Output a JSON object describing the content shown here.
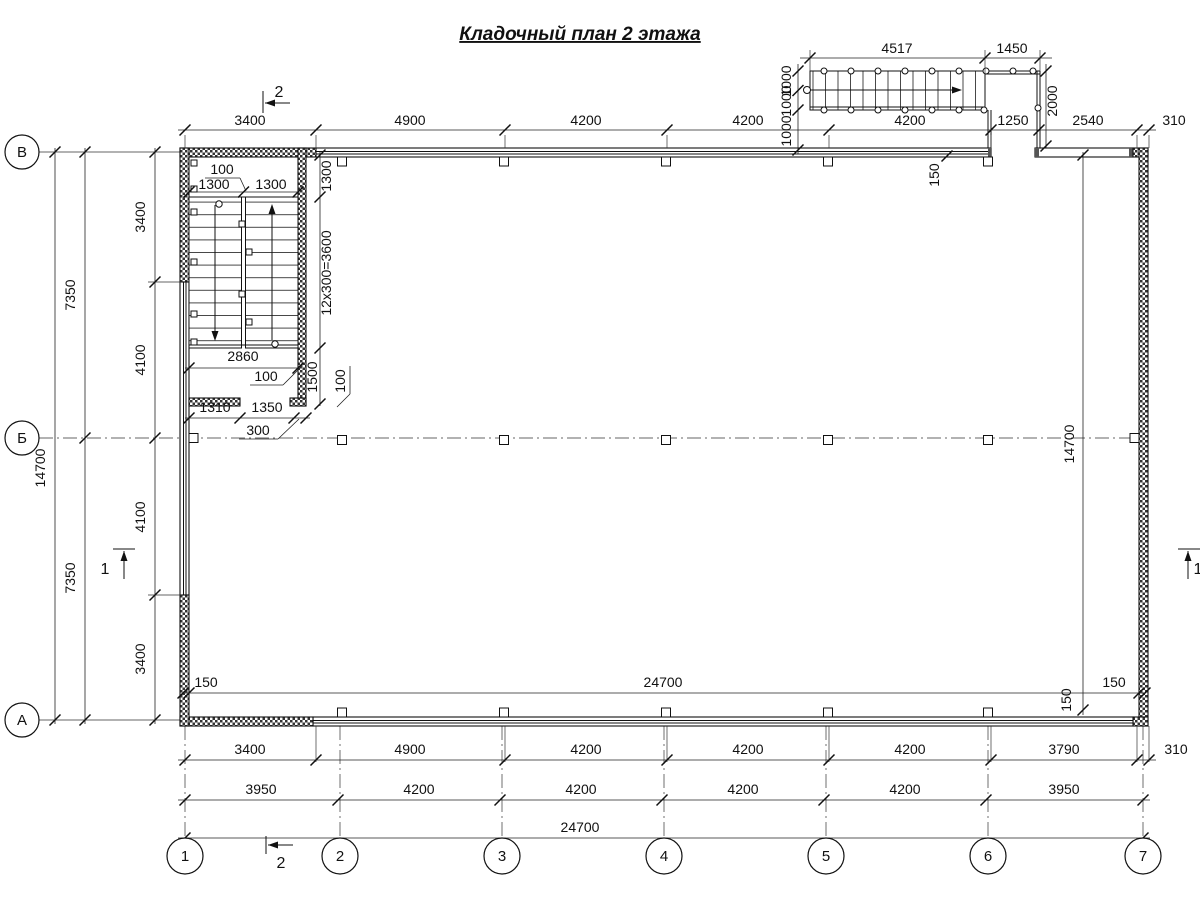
{
  "title": "Кладочный план 2 этажа",
  "axes": {
    "rows": [
      "В",
      "Б",
      "А"
    ],
    "cols": [
      "1",
      "2",
      "3",
      "4",
      "5",
      "6",
      "7"
    ]
  },
  "sections": {
    "cut1": "1",
    "cut2": "2"
  },
  "dims": {
    "top_row": [
      "3400",
      "4900",
      "4200",
      "4200",
      "4200",
      "1250",
      "2540",
      "310"
    ],
    "escape": {
      "top": [
        "4517",
        "1450"
      ],
      "left": [
        "1000",
        "1000",
        "1000"
      ],
      "height": "2000",
      "offset": "150"
    },
    "left": {
      "total": "14700",
      "halves": [
        "7350",
        "7350"
      ],
      "inner": [
        "3400",
        "4100",
        "4100",
        "3400"
      ]
    },
    "stairwell": {
      "gap": "100",
      "flight_l": "1300",
      "flight_r": "1300",
      "landing": "1300",
      "run": "12x300=3600",
      "width": "2860",
      "wall": "100",
      "wall2": "100",
      "below": "1500",
      "seg1": "1310",
      "seg2": "1350",
      "pier": "300"
    },
    "interior": {
      "left_off": "150",
      "width": "24700",
      "right_off": "150",
      "height": "14700",
      "bottom_off": "150"
    },
    "bottom1": [
      "3400",
      "4900",
      "4200",
      "4200",
      "4200",
      "3790",
      "310"
    ],
    "bottom2": [
      "3950",
      "4200",
      "4200",
      "4200",
      "4200",
      "3950"
    ],
    "bottom_total": "24700"
  }
}
